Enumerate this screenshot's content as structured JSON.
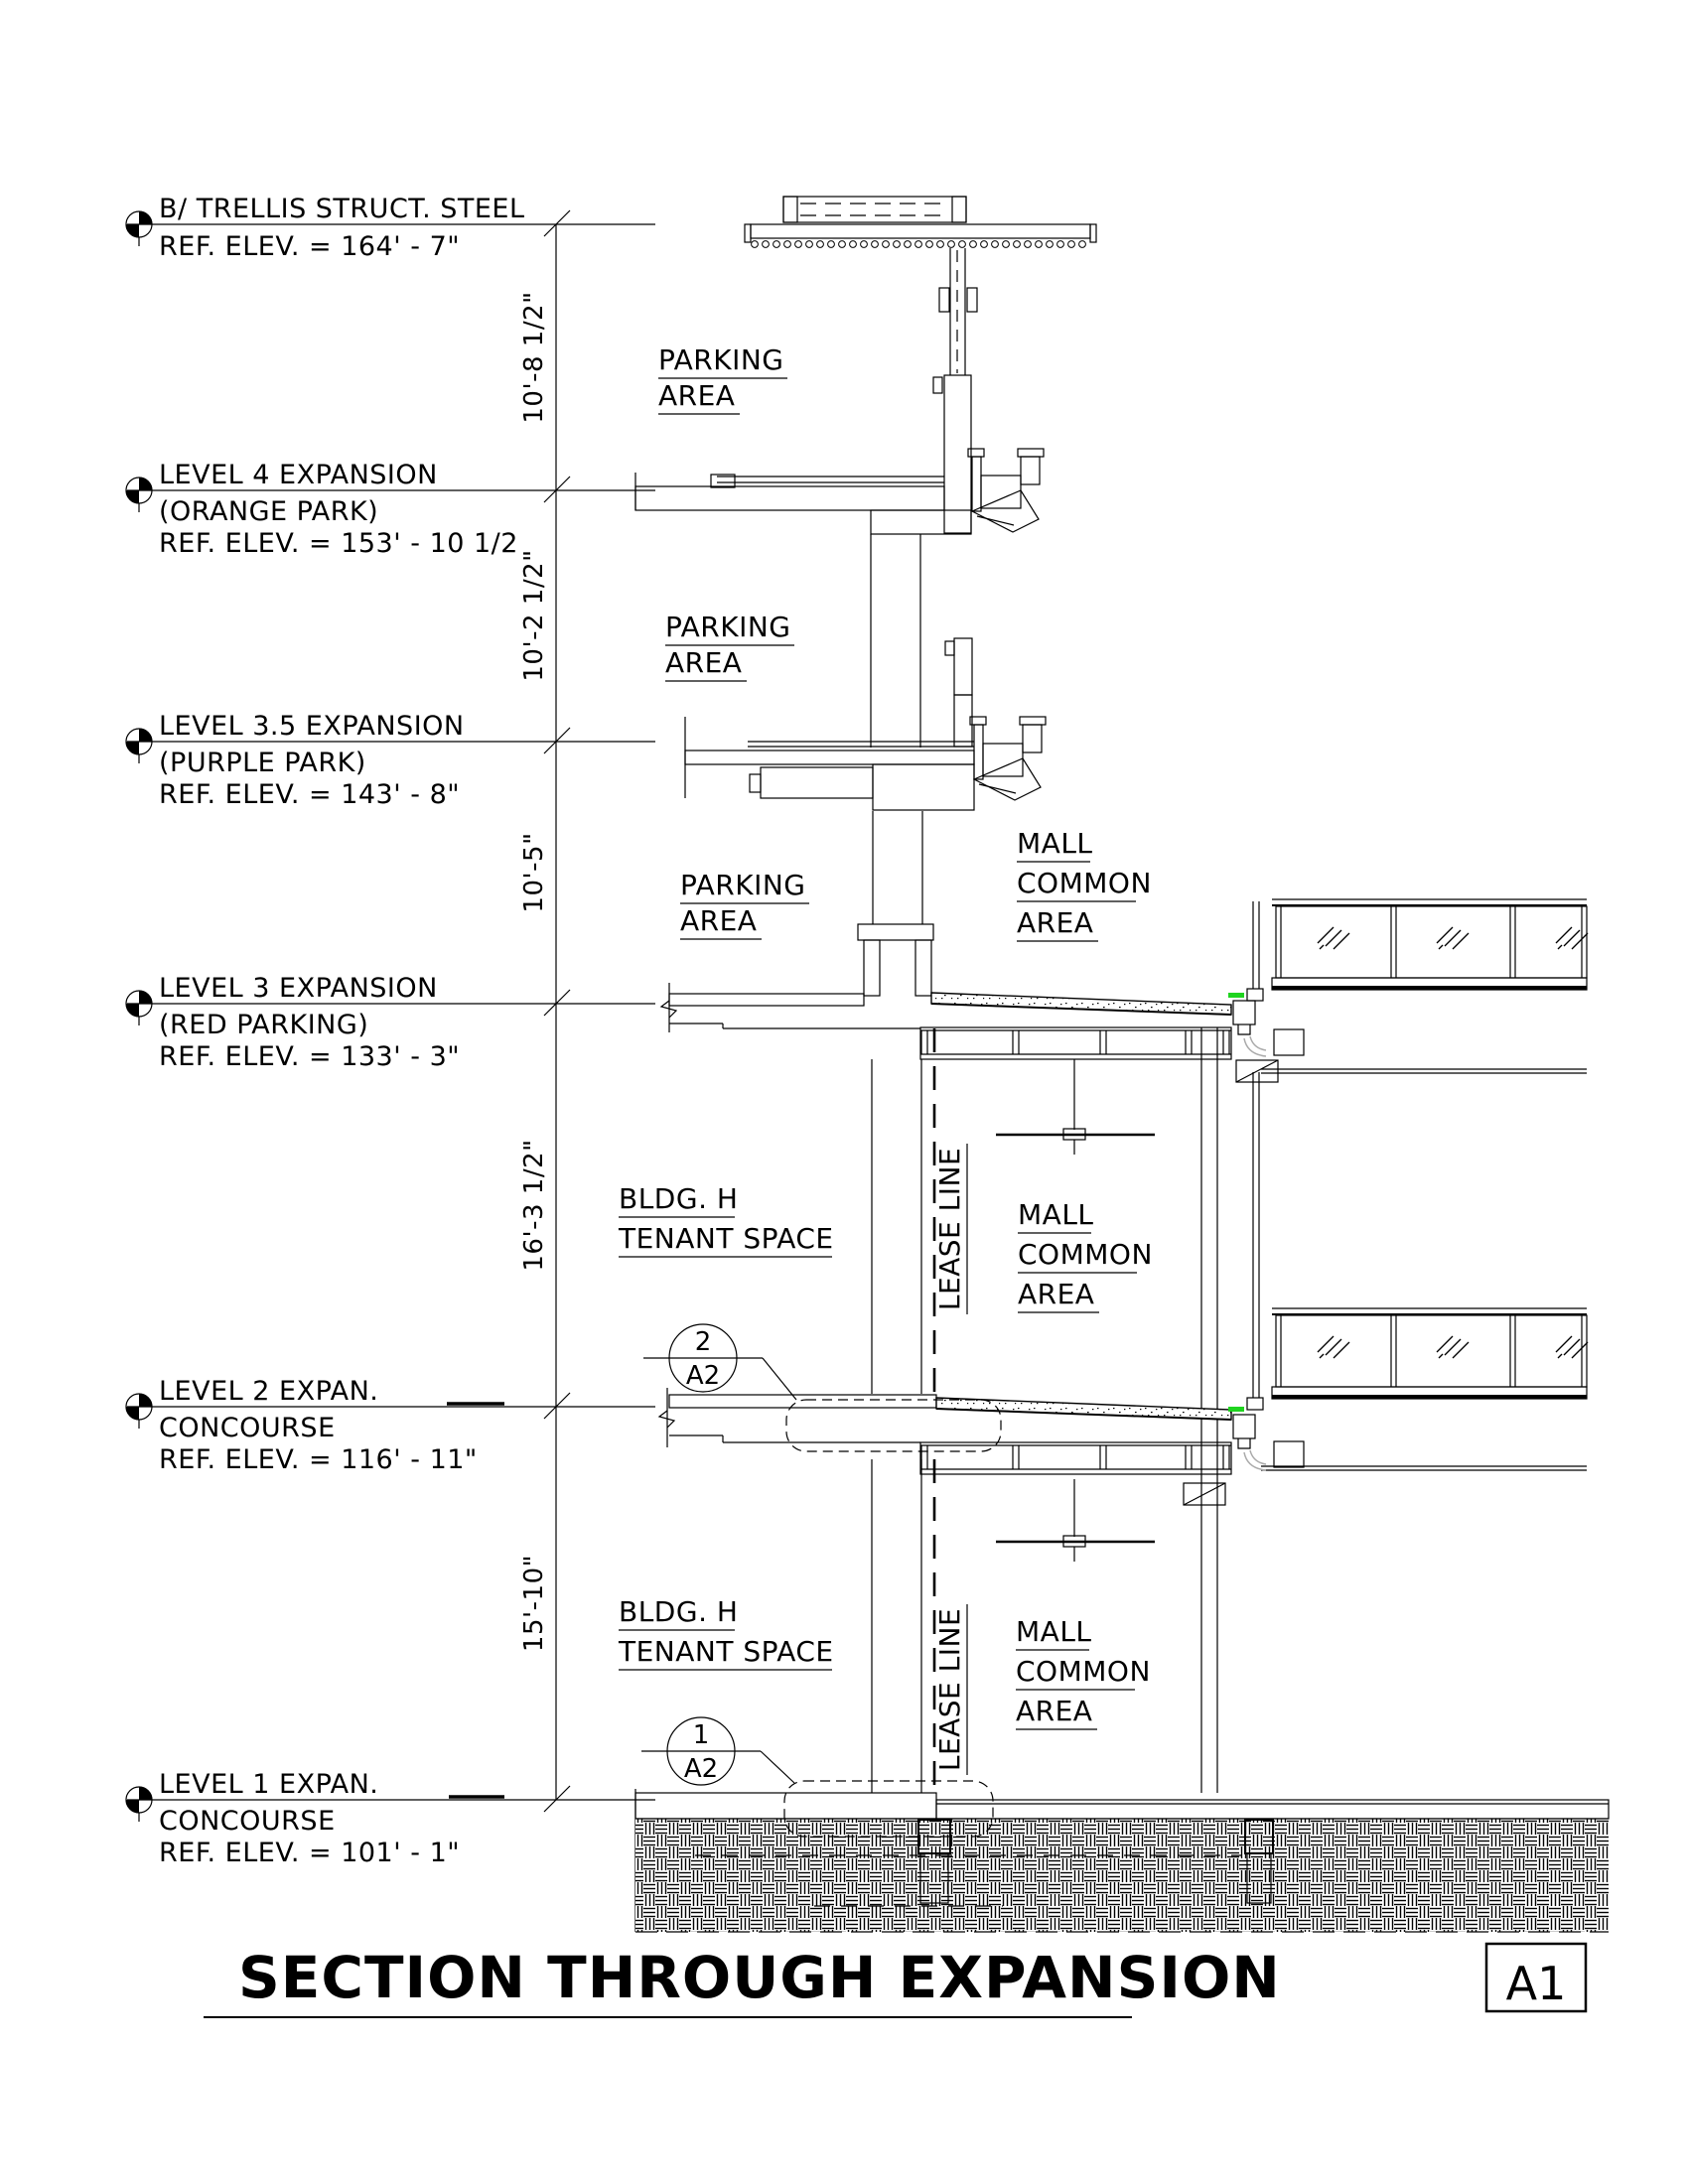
{
  "title": {
    "text": "SECTION THROUGH EXPANSION",
    "ref": "A1"
  },
  "levels": [
    {
      "name": "B/ TRELLIS STRUCT. STEEL",
      "sub": "",
      "elev": "REF. ELEV. = 164' - 7\""
    },
    {
      "name": "LEVEL 4 EXPANSION",
      "sub": "(ORANGE PARK)",
      "elev": "REF. ELEV. = 153' - 10 1/2"
    },
    {
      "name": "LEVEL 3.5 EXPANSION",
      "sub": "(PURPLE PARK)",
      "elev": "REF. ELEV. = 143' - 8\""
    },
    {
      "name": "LEVEL 3 EXPANSION",
      "sub": "(RED PARKING)",
      "elev": "REF. ELEV. = 133' - 3\""
    },
    {
      "name": "LEVEL 2 EXPAN.",
      "sub": "CONCOURSE",
      "elev": "REF. ELEV. = 116' - 11\""
    },
    {
      "name": "LEVEL 1 EXPAN.",
      "sub": "CONCOURSE",
      "elev": "REF. ELEV. = 101' - 1\""
    }
  ],
  "dims": [
    "10'-8 1/2\"",
    "10'-2 1/2\"",
    "10'-5\"",
    "16'-3 1/2\"",
    "15'-10\""
  ],
  "areas": {
    "parking": {
      "l1": "PARKING",
      "l2": "AREA"
    },
    "mall": {
      "l1": "MALL",
      "l2": "COMMON",
      "l3": "AREA"
    },
    "tenant": {
      "l1": "BLDG. H",
      "l2": "TENANT SPACE"
    },
    "lease": "LEASE LINE"
  },
  "callouts": [
    {
      "num": "2",
      "sheet": "A2"
    },
    {
      "num": "1",
      "sheet": "A2"
    }
  ],
  "colors": {
    "highlight_green": "#1fd41f",
    "line": "#000000"
  }
}
